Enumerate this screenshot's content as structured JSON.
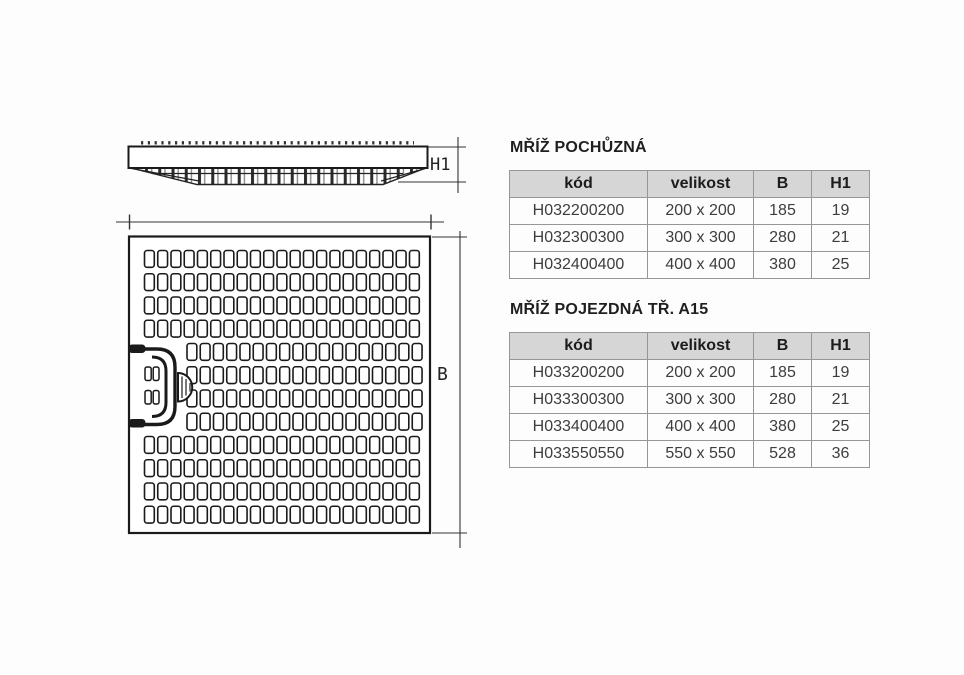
{
  "drawing": {
    "side_view_label": "H1",
    "plan_view_label": "B"
  },
  "sections": [
    {
      "title": "MŘÍŽ POCHŮZNÁ",
      "table": {
        "headers": [
          "kód",
          "velikost",
          "B",
          "H1"
        ],
        "rows": [
          [
            "H032200200",
            "200 x 200",
            "185",
            "19"
          ],
          [
            "H032300300",
            "300 x 300",
            "280",
            "21"
          ],
          [
            "H032400400",
            "400 x 400",
            "380",
            "25"
          ]
        ]
      }
    },
    {
      "title": "MŘÍŽ POJEZDNÁ TŘ. A15",
      "table": {
        "headers": [
          "kód",
          "velikost",
          "B",
          "H1"
        ],
        "rows": [
          [
            "H033200200",
            "200 x 200",
            "185",
            "19"
          ],
          [
            "H033300300",
            "300 x 300",
            "280",
            "21"
          ],
          [
            "H033400400",
            "400 x 400",
            "380",
            "25"
          ],
          [
            "H033550550",
            "550 x 550",
            "528",
            "36"
          ]
        ]
      }
    }
  ]
}
